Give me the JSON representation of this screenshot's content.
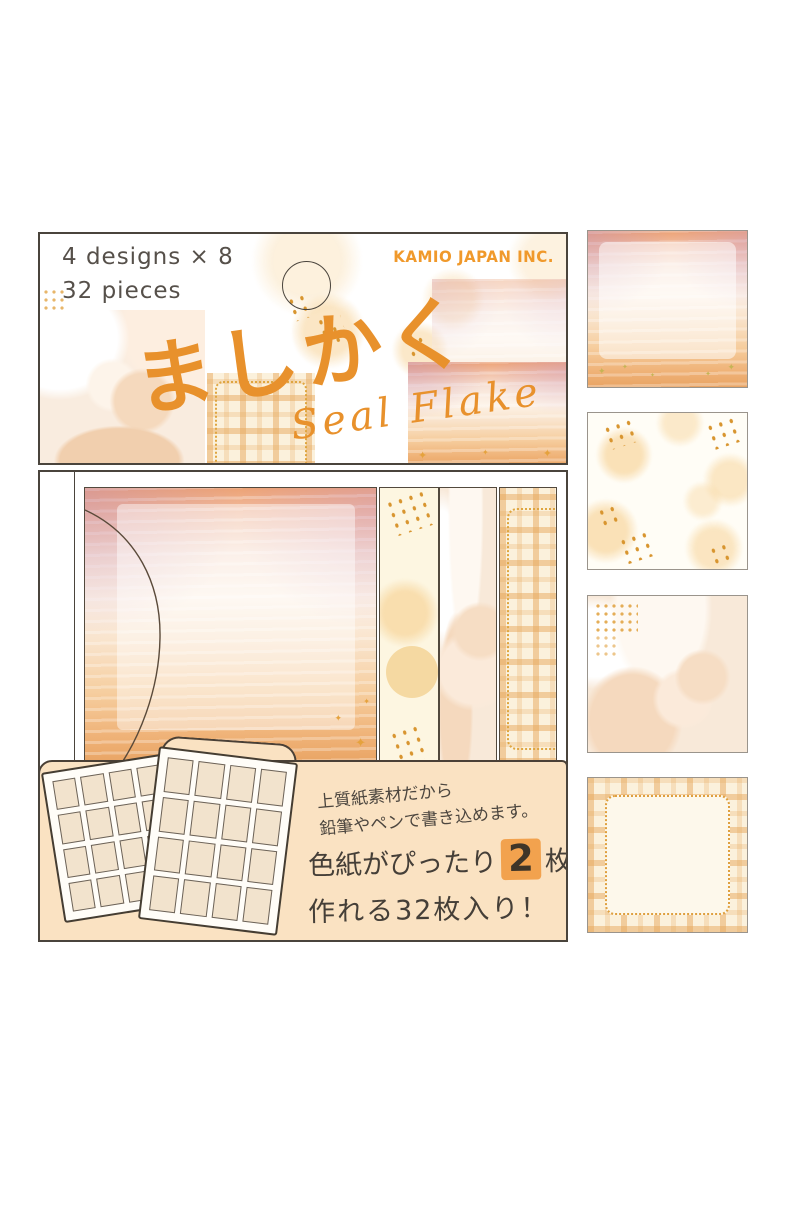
{
  "package": {
    "header": {
      "designs_line1": "4 designs × 8",
      "designs_line2": "32 pieces",
      "brand": "KAMIO JAPAN INC.",
      "title_jp": "ましかく",
      "title_script": "Seal Flake"
    },
    "description": {
      "line1": "上質紙素材だから",
      "line2": "鉛筆やペンで書き込めます。",
      "line3_prefix": "色紙がぴったり",
      "line3_highlight": "2",
      "line3_suffix": "枚分",
      "line4": "作れる32枚入り！"
    },
    "sticker_sheets": {
      "sheet_count": 2,
      "grid_rows": 4,
      "grid_cols": 4
    }
  },
  "designs": [
    "sunset-sky",
    "bokeh-dots",
    "dessert-photo",
    "plaid-frame"
  ],
  "colors": {
    "accent_orange": "#E8912C",
    "brand_orange": "#F0992B",
    "peach_panel": "#FAE2C2",
    "highlight": "#F2A24E",
    "text_dark": "#4C463F"
  }
}
